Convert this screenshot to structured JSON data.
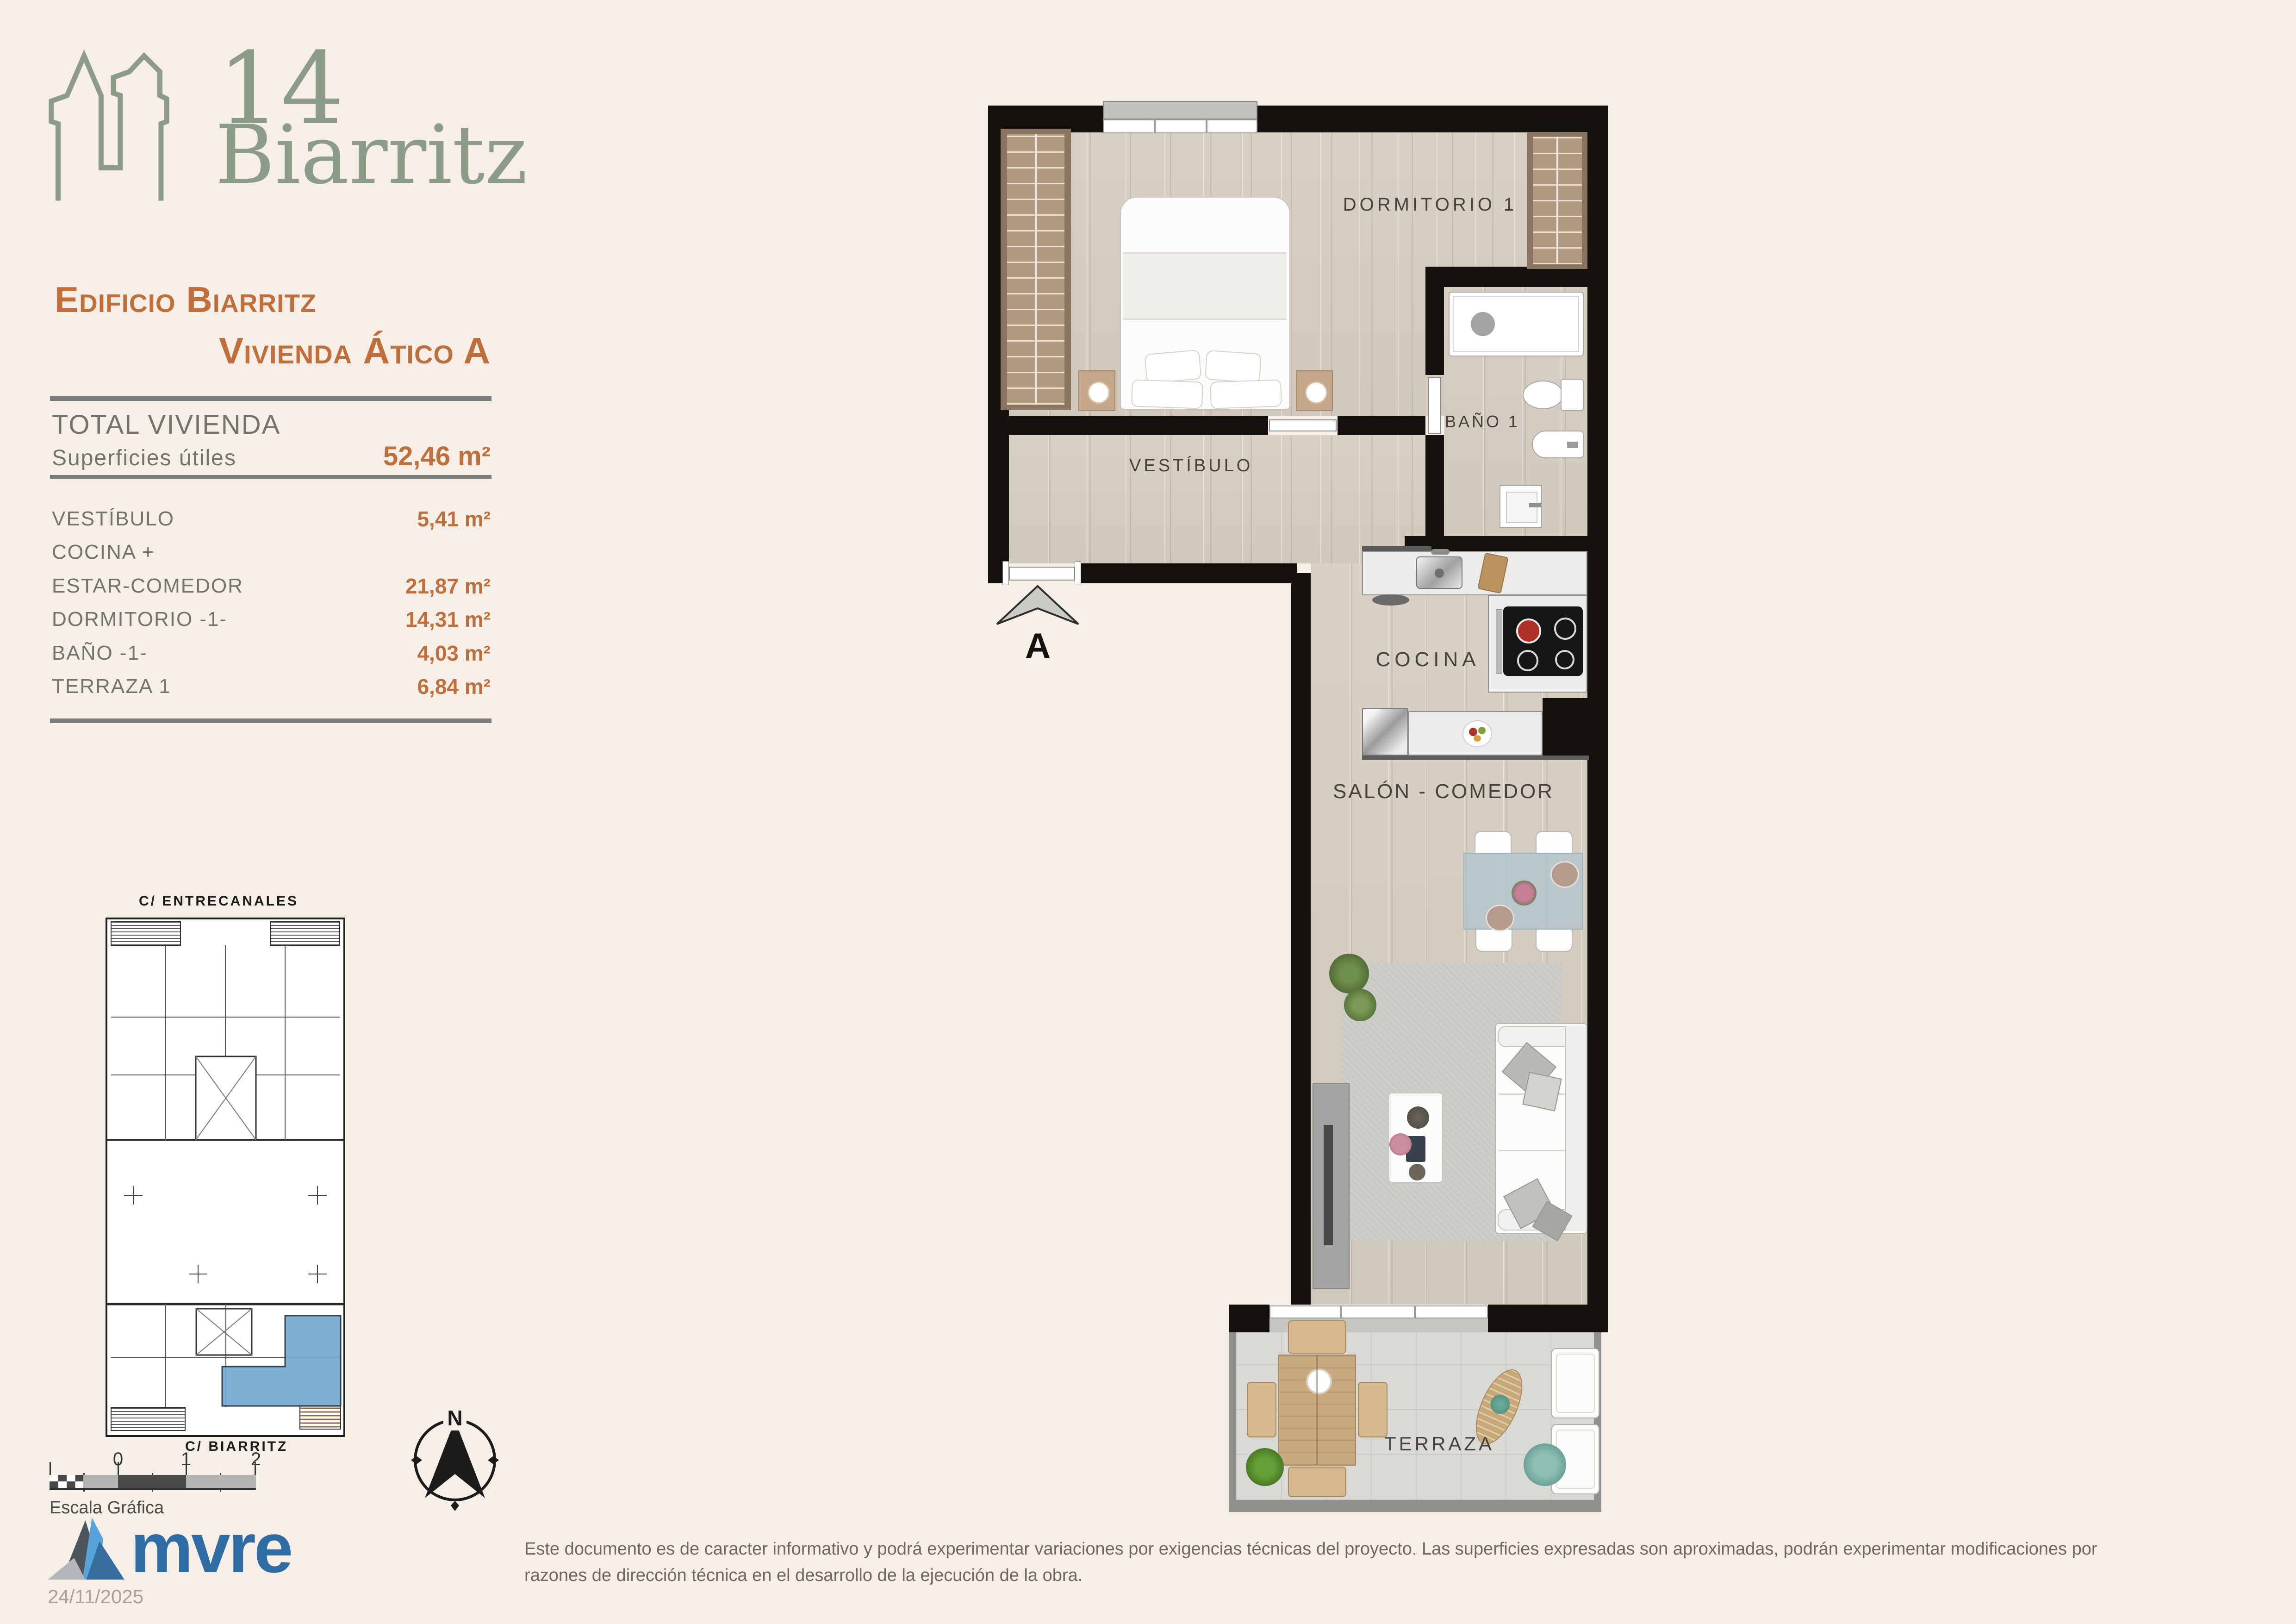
{
  "colors": {
    "background": "#f6efe8",
    "accent_orange": "#bf6f3c",
    "sage_green": "#8d9c88",
    "brand_blue": "#2e6ca3",
    "site_highlight": "#74aad2",
    "wall": "#14110d"
  },
  "logo": {
    "number": "14",
    "name": "Biarritz"
  },
  "title": {
    "line1": "Edificio Biarritz",
    "line2": "Vivienda Ático A"
  },
  "summary": {
    "total_label": "TOTAL VIVIENDA",
    "surface_label": "Superficies útiles",
    "total_value": "52,46 m²"
  },
  "rooms": [
    {
      "name": "VESTÍBULO",
      "value": "5,41 m²"
    },
    {
      "name": "COCINA +",
      "value": ""
    },
    {
      "name": "ESTAR-COMEDOR",
      "value": "21,87 m²"
    },
    {
      "name": "DORMITORIO -1-",
      "value": "14,31 m²"
    },
    {
      "name": "BAÑO -1-",
      "value": "4,03 m²"
    },
    {
      "name": "TERRAZA 1",
      "value": "6,84 m²"
    }
  ],
  "plan": {
    "labels": {
      "bedroom": "DORMITORIO 1",
      "bath": "BAÑO 1",
      "hall": "VESTÍBULO",
      "kitchen": "COCINA",
      "living": "SALÓN - COMEDOR",
      "terrace": "TERRAZA"
    },
    "entrance_letter": "A"
  },
  "siteplan": {
    "street_top": "C/ ENTRECANALES",
    "street_bottom": "C/ BIARRITZ"
  },
  "scalebar": {
    "ticks": [
      "0",
      "1",
      "2"
    ],
    "caption": "Escala Gráfica"
  },
  "compass": {
    "north": "N"
  },
  "footer": {
    "brand": "mvre",
    "date": "24/11/2025",
    "disclaimer_line1": "Este documento es de caracter informativo y podrá experimentar variaciones por exigencias técnicas del proyecto. Las superficies expresadas son aproximadas, podrán experimentar modificaciones por",
    "disclaimer_line2": "razones de dirección técnica en el desarrollo de la ejecución de la obra."
  }
}
